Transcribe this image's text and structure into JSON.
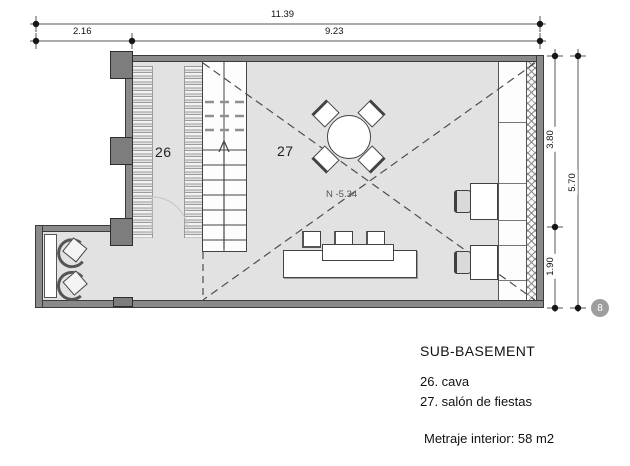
{
  "drawing": {
    "floor_title": "SUB-BASEMENT",
    "legend": [
      "26. cava",
      "27. salón de fiestas"
    ],
    "area_note": "Metraje interior: 58 m2",
    "level_label": "N -5.34",
    "sheet_marker": "8",
    "rooms": [
      {
        "id": "26",
        "name": "cava"
      },
      {
        "id": "27",
        "name": "salón de fiestas"
      }
    ],
    "dimensions": {
      "top_total": "11.39",
      "top_left": "2.16",
      "top_right": "9.23",
      "right_upper": "3.80",
      "right_lower": "1.90",
      "right_total": "5.70"
    },
    "colors": {
      "wall": "#8a8a8a",
      "floor": "#e2e2e2",
      "line": "#444444",
      "dashed_line": "#4e4e4e",
      "marker": "#9e9e9e"
    }
  }
}
